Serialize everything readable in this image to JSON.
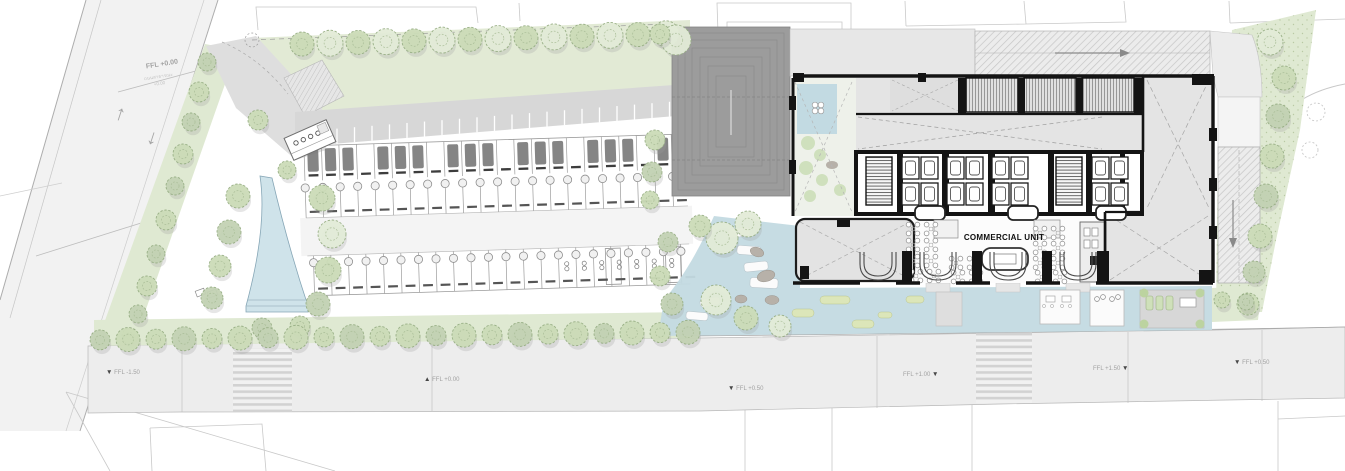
{
  "road_west": {
    "ffl_label": "FFL +0.00",
    "note": "ถนนสาธารณะ",
    "note_level": "+0.00"
  },
  "icons": {
    "up_arrow": "↑",
    "down_arrow": "↓",
    "marker_down": "▼",
    "marker_up": "▲"
  },
  "building": {
    "commercial_unit_label": "COMMERCIAL UNIT"
  },
  "street_levels": [
    {
      "label": "FFL -1.50",
      "marker": "▼"
    },
    {
      "label": "FFL +0.00",
      "marker": "▲"
    },
    {
      "label": "FFL +0.50",
      "marker": "▼"
    },
    {
      "label": "FFL +1.00",
      "marker": "▼"
    },
    {
      "label": "FFL +1.50",
      "marker": "▼"
    },
    {
      "label": "FFL +0.50",
      "marker": "▼"
    }
  ],
  "colors": {
    "water": "#c3dae1",
    "pool": "#cfe3ea",
    "greenery": "#dfe9d2",
    "tree_canopy": "#ccdcb8",
    "building_wall": "#141414",
    "building_floor": "#e6e6e6",
    "paving": "#ededed",
    "ramp_dark": "#9c9c9c",
    "label_gray": "#a2a2a2"
  }
}
